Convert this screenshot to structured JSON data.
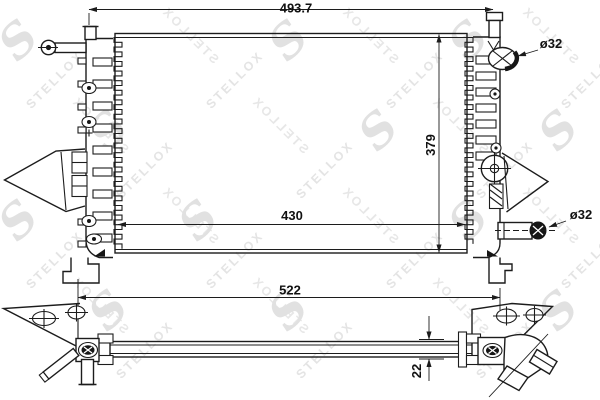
{
  "watermark": {
    "brand": "STELLOX",
    "logo_letter": "S"
  },
  "dimensions": {
    "overall_width_mm": "493.7",
    "core_height_mm": "379",
    "core_width_mm": "430",
    "overall_length_mm": "522",
    "core_thickness_mm": "22",
    "inlet_diameter": "ø32",
    "outlet_diameter": "ø32"
  },
  "colors": {
    "line": "#1c1c1c",
    "watermark": "#e4e4e4",
    "background": "#ffffff"
  }
}
